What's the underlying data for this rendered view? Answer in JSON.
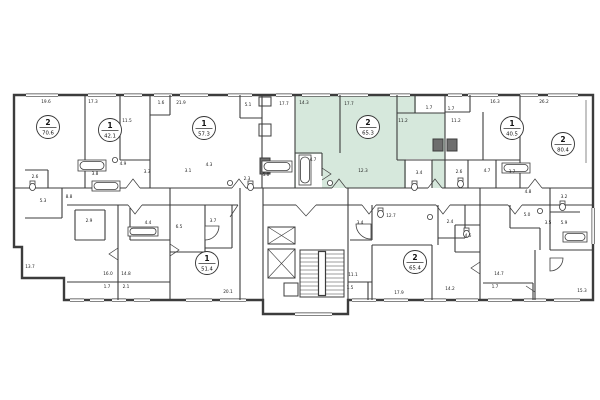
{
  "plan": {
    "highlight_color": "#d6e8dc",
    "wall_color": "#3c3c3c",
    "units": [
      {
        "rooms": "2",
        "area": "70.6",
        "cx": 48,
        "cy": 127,
        "highlighted": false
      },
      {
        "rooms": "1",
        "area": "42.1",
        "cx": 110,
        "cy": 130,
        "highlighted": false
      },
      {
        "rooms": "1",
        "area": "57.3",
        "cx": 204,
        "cy": 128,
        "highlighted": false
      },
      {
        "rooms": "2",
        "area": "65.3",
        "cx": 368,
        "cy": 127,
        "highlighted": true
      },
      {
        "rooms": "1",
        "area": "40.5",
        "cx": 512,
        "cy": 128,
        "highlighted": false
      },
      {
        "rooms": "2",
        "area": "80.4",
        "cx": 563,
        "cy": 144,
        "highlighted": false
      },
      {
        "rooms": "1",
        "area": "51.4",
        "cx": 207,
        "cy": 263,
        "highlighted": false
      },
      {
        "rooms": "2",
        "area": "65.4",
        "cx": 415,
        "cy": 262,
        "highlighted": false
      }
    ],
    "room_labels": [
      {
        "t": "19.6",
        "x": 46,
        "y": 103
      },
      {
        "t": "17.3",
        "x": 93,
        "y": 103
      },
      {
        "t": "11.5",
        "x": 127,
        "y": 122
      },
      {
        "t": "1.6",
        "x": 161,
        "y": 104
      },
      {
        "t": "21.9",
        "x": 181,
        "y": 104
      },
      {
        "t": "5.1",
        "x": 248,
        "y": 106
      },
      {
        "t": "17.7",
        "x": 284,
        "y": 105
      },
      {
        "t": "14.3",
        "x": 304,
        "y": 104
      },
      {
        "t": "17.7",
        "x": 349,
        "y": 105
      },
      {
        "t": "11.2",
        "x": 403,
        "y": 122
      },
      {
        "t": "1.7",
        "x": 429,
        "y": 109
      },
      {
        "t": "1.7",
        "x": 451,
        "y": 110
      },
      {
        "t": "11.2",
        "x": 456,
        "y": 122
      },
      {
        "t": "16.3",
        "x": 495,
        "y": 103
      },
      {
        "t": "26.2",
        "x": 544,
        "y": 103
      },
      {
        "t": "2.6",
        "x": 35,
        "y": 178
      },
      {
        "t": "3.8",
        "x": 95,
        "y": 175
      },
      {
        "t": "4.9",
        "x": 123,
        "y": 165
      },
      {
        "t": "3.3",
        "x": 147,
        "y": 173
      },
      {
        "t": "3.1",
        "x": 188,
        "y": 172
      },
      {
        "t": "4.3",
        "x": 209,
        "y": 166
      },
      {
        "t": "2.3",
        "x": 247,
        "y": 180
      },
      {
        "t": "5.0",
        "x": 266,
        "y": 176
      },
      {
        "t": "4.7",
        "x": 313,
        "y": 161
      },
      {
        "t": "12.3",
        "x": 363,
        "y": 172
      },
      {
        "t": "3.4",
        "x": 419,
        "y": 174
      },
      {
        "t": "2.6",
        "x": 459,
        "y": 173
      },
      {
        "t": "4.7",
        "x": 487,
        "y": 172
      },
      {
        "t": "3.7",
        "x": 512,
        "y": 173
      },
      {
        "t": "4.8",
        "x": 528,
        "y": 193
      },
      {
        "t": "3.2",
        "x": 564,
        "y": 198
      },
      {
        "t": "8.8",
        "x": 69,
        "y": 198
      },
      {
        "t": "5.3",
        "x": 43,
        "y": 202
      },
      {
        "t": "2.9",
        "x": 89,
        "y": 222
      },
      {
        "t": "4.4",
        "x": 148,
        "y": 224
      },
      {
        "t": "6.5",
        "x": 179,
        "y": 228
      },
      {
        "t": "3.7",
        "x": 213,
        "y": 222
      },
      {
        "t": "3.4",
        "x": 360,
        "y": 224
      },
      {
        "t": "12.7",
        "x": 391,
        "y": 217
      },
      {
        "t": "2.4",
        "x": 450,
        "y": 223
      },
      {
        "t": "4.6",
        "x": 468,
        "y": 237
      },
      {
        "t": "5.0",
        "x": 527,
        "y": 216
      },
      {
        "t": "3.5",
        "x": 548,
        "y": 224
      },
      {
        "t": "5.9",
        "x": 564,
        "y": 224
      },
      {
        "t": "13.7",
        "x": 30,
        "y": 268
      },
      {
        "t": "16.0",
        "x": 108,
        "y": 275
      },
      {
        "t": "14.8",
        "x": 126,
        "y": 275
      },
      {
        "t": "1.7",
        "x": 107,
        "y": 288
      },
      {
        "t": "2.1",
        "x": 126,
        "y": 288
      },
      {
        "t": "20.1",
        "x": 228,
        "y": 293
      },
      {
        "t": "11.1",
        "x": 353,
        "y": 276
      },
      {
        "t": "1.5",
        "x": 350,
        "y": 289
      },
      {
        "t": "17.9",
        "x": 399,
        "y": 294
      },
      {
        "t": "14.2",
        "x": 450,
        "y": 290
      },
      {
        "t": "14.7",
        "x": 499,
        "y": 275
      },
      {
        "t": "1.7",
        "x": 495,
        "y": 288
      },
      {
        "t": "15.3",
        "x": 582,
        "y": 292
      }
    ]
  }
}
